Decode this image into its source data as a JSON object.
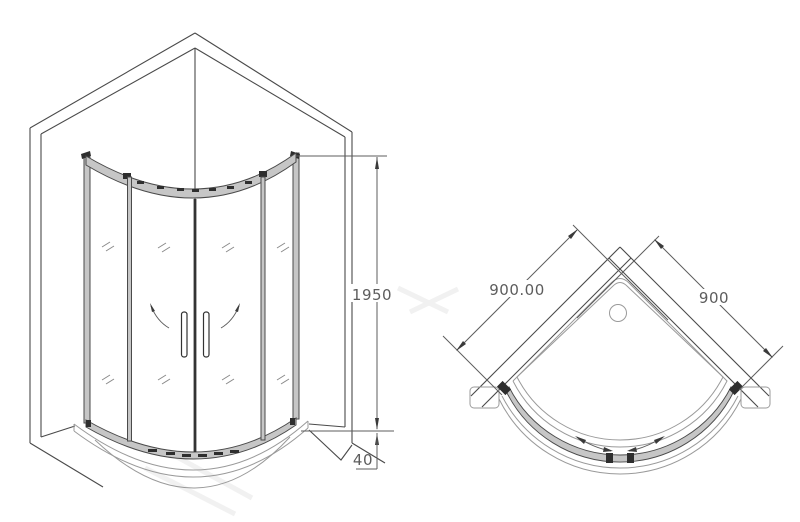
{
  "drawing": {
    "type": "technical-cad-drawing",
    "subject": "quadrant shower enclosure with double sliding doors",
    "front_view": {
      "label": "front elevation",
      "dims": {
        "glass_height": "1950",
        "tray_height": "40"
      }
    },
    "plan_view": {
      "label": "top plan",
      "dims": {
        "left_side": "900.00",
        "right_side": "900"
      }
    },
    "colors": {
      "background": "#ffffff",
      "line_dark": "#4a4a4a",
      "line_light": "#9a9a9a",
      "dimension": "#5d5d5d",
      "rail_fill": "#c6c6c6",
      "hardware": "#2e2e2e"
    }
  }
}
